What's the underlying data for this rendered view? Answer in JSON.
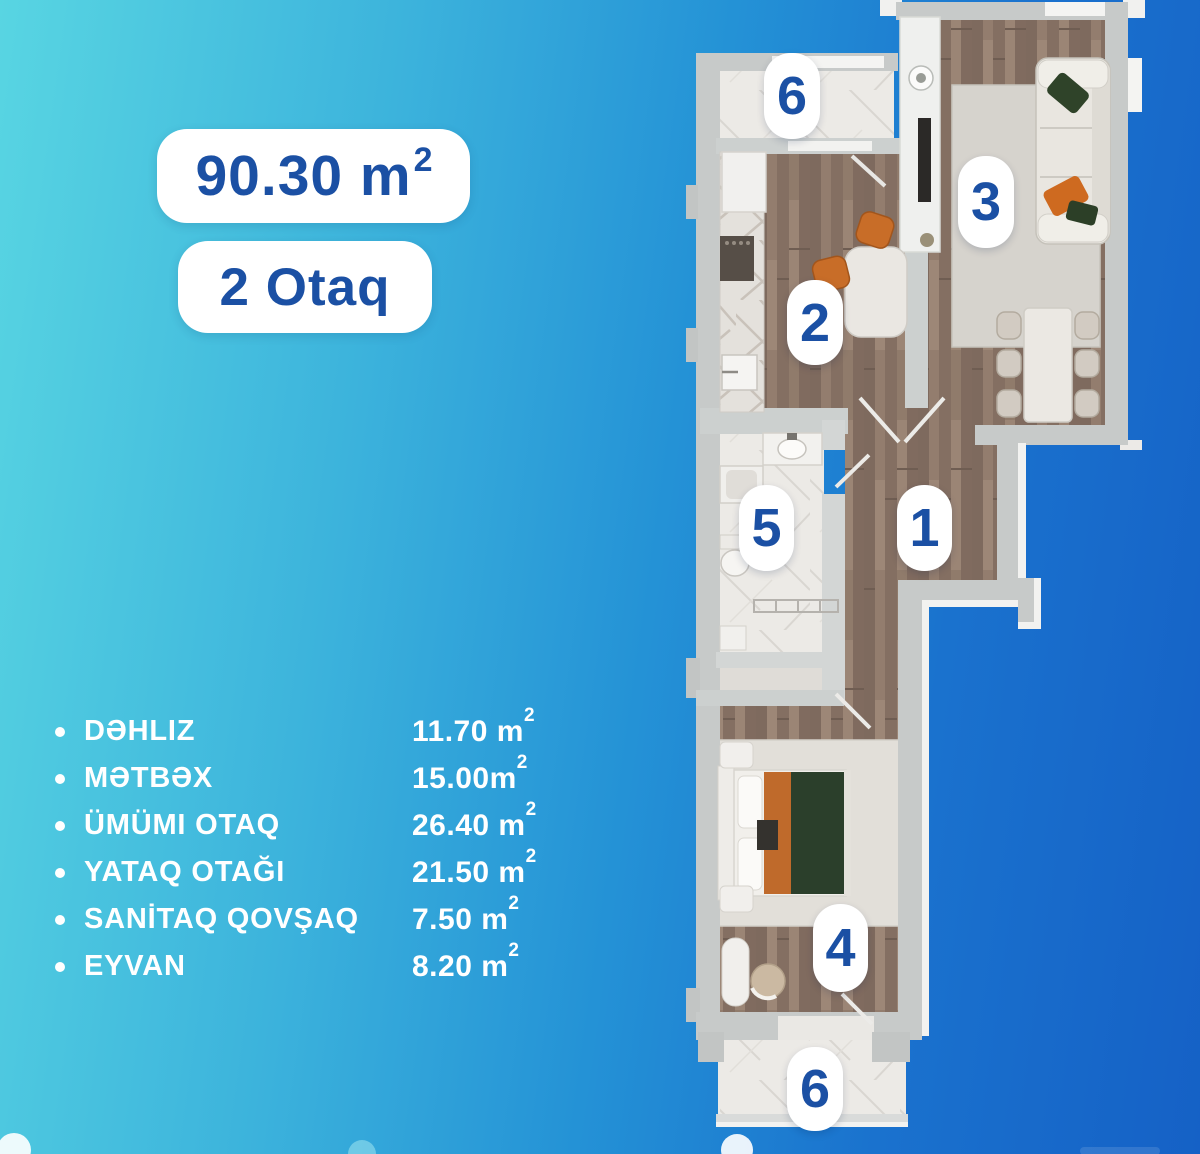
{
  "header": {
    "area": {
      "main": "90.30 m",
      "sup": "2"
    },
    "rooms_label": "2 Otaq"
  },
  "legend": [
    {
      "label": "DƏHLIZ",
      "value": "11.70 m",
      "sup": "2"
    },
    {
      "label": "MƏTBƏX",
      "value": "15.00m",
      "sup": "2"
    },
    {
      "label": "ÜMÜMI OTAQ",
      "value": "26.40 m",
      "sup": "2"
    },
    {
      "label": "YATAQ OTAĞI",
      "value": "21.50 m",
      "sup": "2"
    },
    {
      "label": "SANİTAQ QOVŞAQ",
      "value": "7.50 m",
      "sup": "2"
    },
    {
      "label": "EYVAN",
      "value": "8.20 m",
      "sup": "2"
    }
  ],
  "plan_badges": [
    {
      "number": "6"
    },
    {
      "number": "2"
    },
    {
      "number": "3"
    },
    {
      "number": "5"
    },
    {
      "number": "1"
    },
    {
      "number": "4"
    },
    {
      "number": "6"
    }
  ],
  "colors": {
    "accent_text": "#1b50a4",
    "badge_bg": "#ffffff",
    "bg_gradient_start": "#58d5e2",
    "bg_gradient_end": "#1561c6",
    "wall_gray": "#c7cac9",
    "wood_floor": "#8a7466",
    "marble_floor": "#eceae6"
  }
}
